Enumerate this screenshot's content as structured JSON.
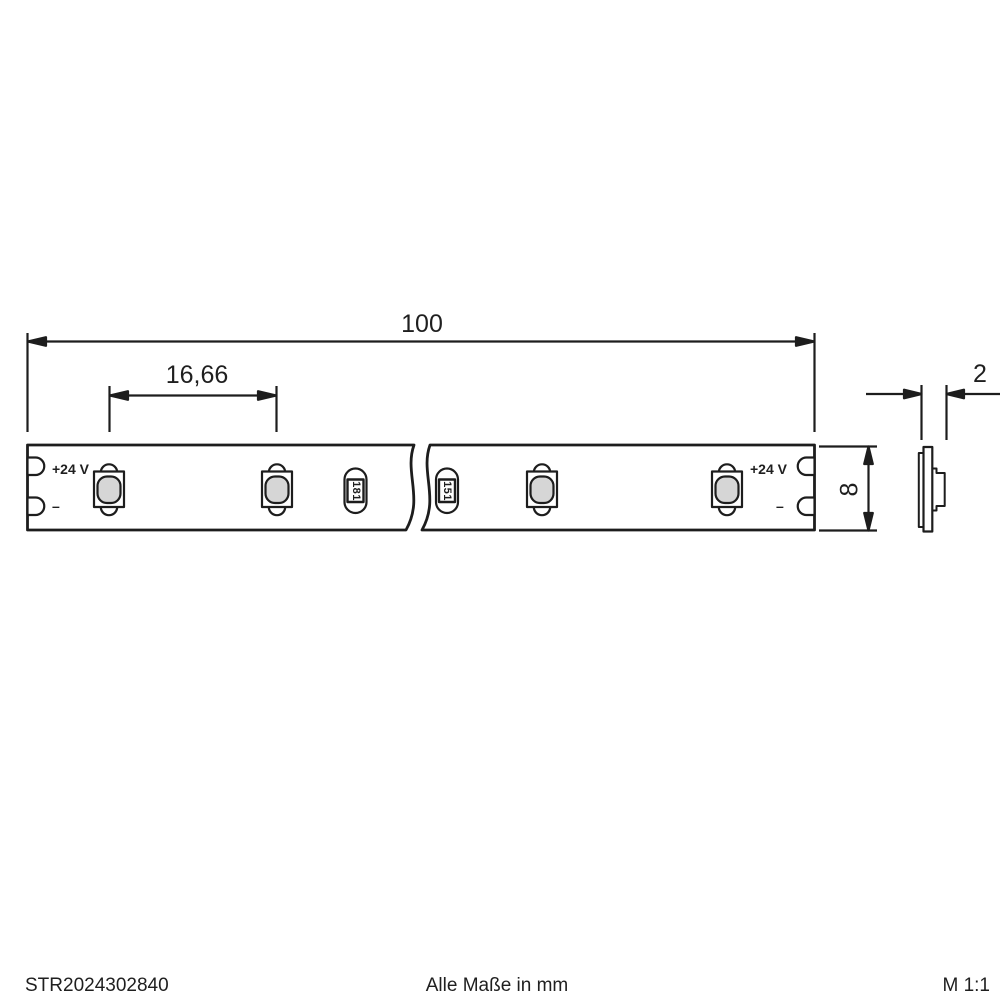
{
  "colors": {
    "line": "#1d1d1d",
    "lens_fill": "#d6d6d6",
    "background": "#ffffff"
  },
  "drawing": {
    "dimensions": {
      "total_length": "100",
      "led_pitch": "16,66",
      "strip_width": "8",
      "strip_thickness": "2"
    },
    "strip": {
      "left_terminal": {
        "positive": "+24 V",
        "negative": "–"
      },
      "right_terminal": {
        "positive": "+24 V",
        "negative": "–"
      },
      "resistors": [
        {
          "label": "181"
        },
        {
          "label": "151"
        }
      ],
      "led_count_visible": 4
    }
  },
  "footer": {
    "article_number": "STR2024302840",
    "units_note": "Alle Maße in mm",
    "scale": "M 1:1"
  }
}
